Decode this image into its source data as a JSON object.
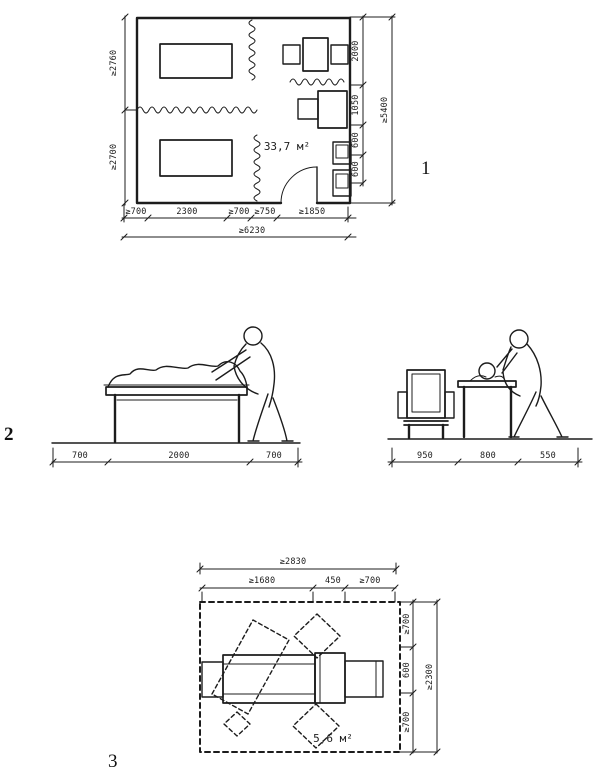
{
  "colors": {
    "ink": "#1c1c1c",
    "paper": "#ffffff"
  },
  "figure1": {
    "number": "1",
    "area_label": "33,7 м²",
    "left_dims": [
      "≥2760",
      "≥2700"
    ],
    "right_dims": [
      "2000",
      "1050",
      "600",
      "600"
    ],
    "right_total": "≥5400",
    "bottom_dims": [
      "≥700",
      "2300",
      "≥700",
      "≥750",
      "≥1850"
    ],
    "bottom_total": "≥6230"
  },
  "figure2": {
    "number": "2",
    "couch_dims": [
      "700",
      "2000",
      "700"
    ],
    "chair_dims": [
      "950",
      "800",
      "550"
    ]
  },
  "figure3": {
    "number": "3",
    "area_label": "5,6 м²",
    "top_total": "≥2830",
    "top_dims": [
      "≥1680",
      "450",
      "≥700"
    ],
    "right_dims": [
      "≥700",
      "600",
      "≥700"
    ],
    "right_total": "≥2300"
  }
}
